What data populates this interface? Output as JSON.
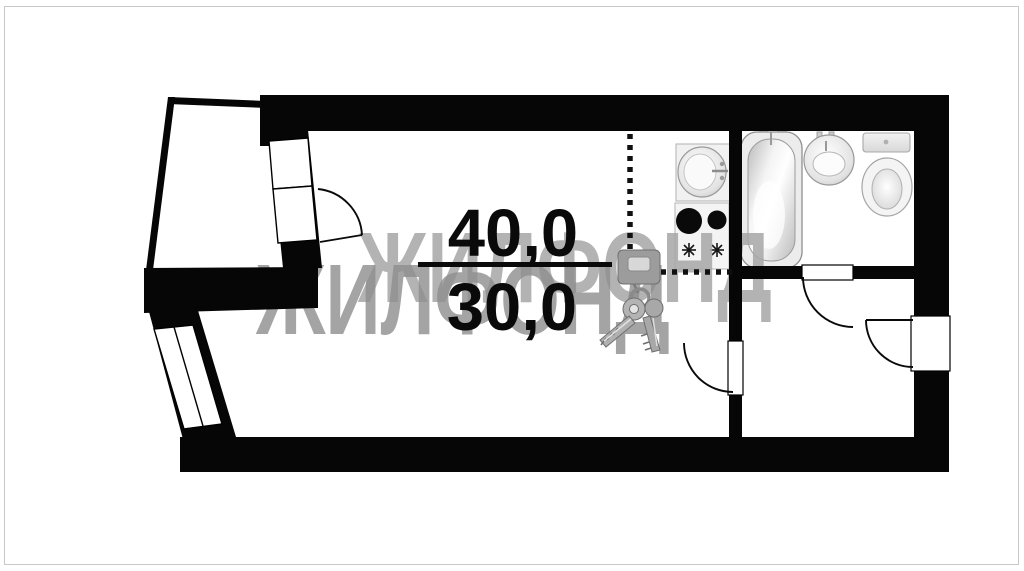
{
  "plan": {
    "kind": "apartment-floor-plan",
    "area_label": {
      "total": "40,0",
      "living": "30,0"
    },
    "watermark": {
      "text": "ЖИЛФОНД",
      "back_color": "#a6a6a6",
      "front_color": "#8d8d8d"
    },
    "colors": {
      "wall": "#060606",
      "background": "#ffffff",
      "frame_border": "#c9c9c9",
      "label_text": "#0a0a0a"
    },
    "fixtures": [
      {
        "name": "kitchen-sink"
      },
      {
        "name": "stove"
      },
      {
        "name": "bathtub"
      },
      {
        "name": "washbasin"
      },
      {
        "name": "toilet"
      },
      {
        "name": "keys-graphic"
      }
    ]
  }
}
